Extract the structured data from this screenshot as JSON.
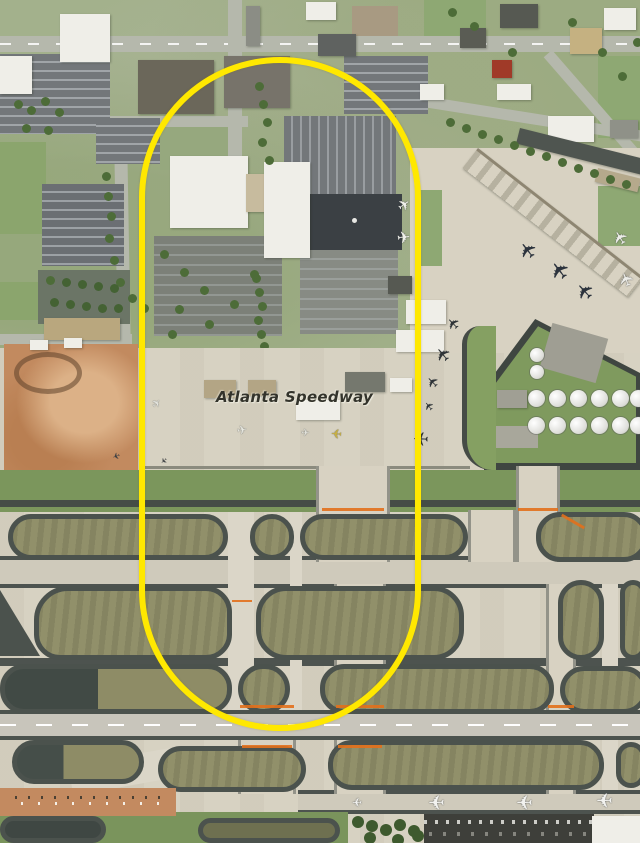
{
  "page": {
    "type": "aerial-satellite-map-screenshot",
    "size": "640x843"
  },
  "map": {
    "place_label": "Atlanta Speedway",
    "annotation": {
      "shape": "rounded-pill-outline",
      "color": "#ffe800",
      "description": "yellow oval highlight around office park, general-aviation apron and taxiways"
    }
  },
  "icons": {
    "airplane": "✈"
  },
  "palette": {
    "concrete_apron": "#d7d2c2",
    "taxiway": "#cfcabb",
    "runway": "#c8c5bb",
    "asphalt_edge": "#4b524d",
    "grass_island": "#91906a",
    "grass": "#7b965c",
    "urban_ground": "#a3b18c",
    "tree": "#4d6c38",
    "parking_lot": "#73777a",
    "building_white": "#efeee8",
    "building_dark": "#5a5d55",
    "red_dirt": "#c28a5f",
    "dark_pavement": "#3b4044",
    "hold_line_orange": "#e2701c"
  }
}
